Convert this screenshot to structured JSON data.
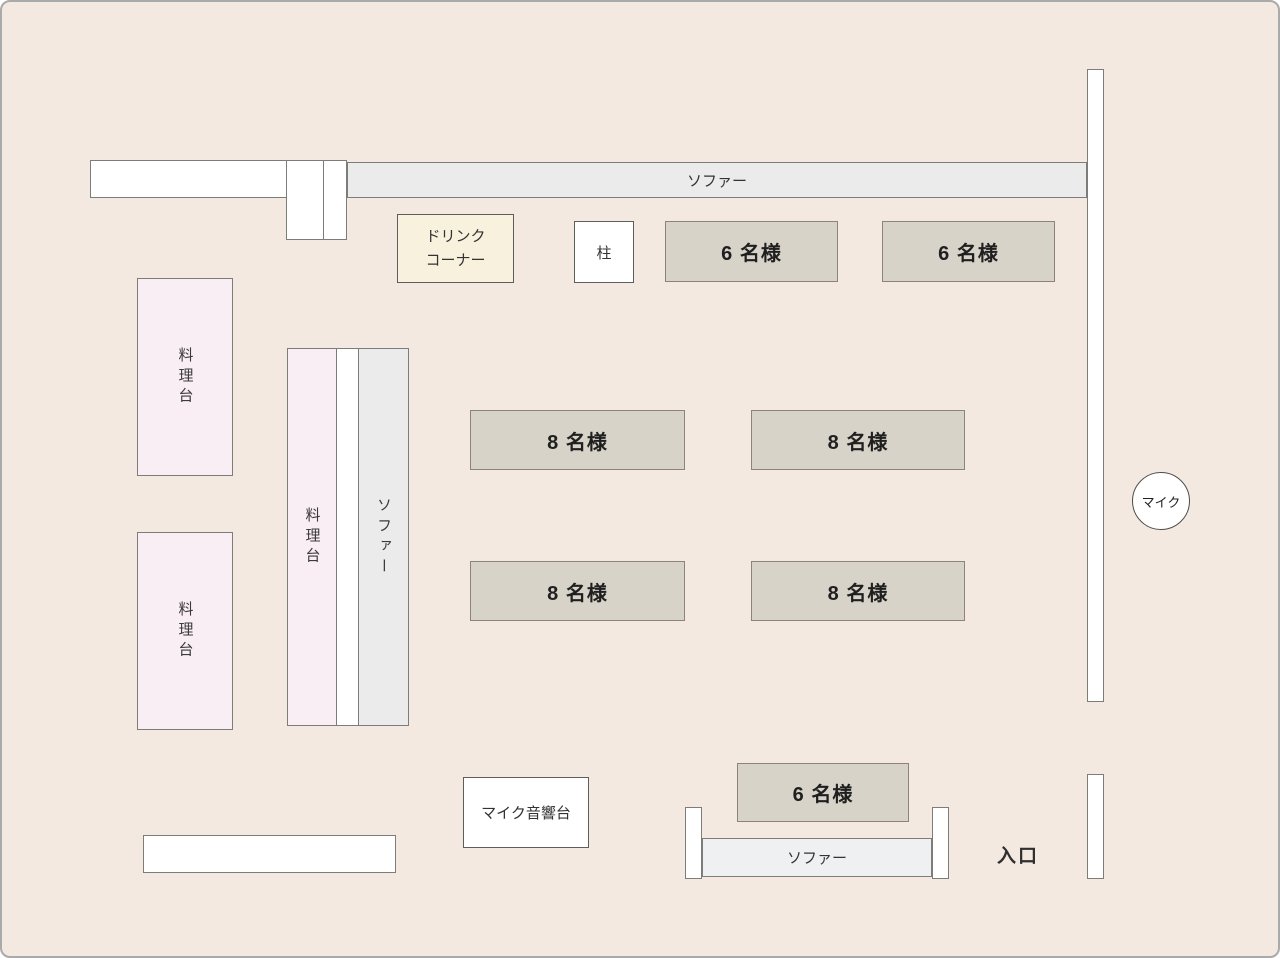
{
  "palette": {
    "background": "#f4e9e0",
    "wall_fill": "#ffffff",
    "sofa_fill": "#ebebeb",
    "sofa_bottom_fill": "#eef0f1",
    "seat_fill": "#d8d3c9",
    "cooking_fill": "#f9eef3",
    "drink_fill": "#f8f1dd",
    "outline": "#7c7c78",
    "seat_outline": "#8c8577",
    "frame": "#aaaaaa",
    "text": "#2b2b2b"
  },
  "floorplan": {
    "sofa_top": {
      "label": "ソファー"
    },
    "drink_corner": {
      "line1": "ドリンク",
      "line2": "コーナー"
    },
    "pillar": {
      "label": "柱"
    },
    "seats_6_top": [
      {
        "label": "6 名様"
      },
      {
        "label": "6 名様"
      }
    ],
    "seats_8": [
      {
        "label": "8 名様"
      },
      {
        "label": "8 名様"
      },
      {
        "label": "8 名様"
      },
      {
        "label": "8 名様"
      }
    ],
    "cooking_tables_left": [
      {
        "label": "料理台"
      },
      {
        "label": "料理台"
      }
    ],
    "island": {
      "cooking_label": "料理台",
      "sofa_label": "ソファー"
    },
    "mic": {
      "label": "マイク"
    },
    "mic_sound_table": {
      "label": "マイク音響台"
    },
    "stage_area": {
      "seat_label": "6 名様",
      "sofa_label": "ソファー"
    },
    "entrance": {
      "label": "入口"
    }
  }
}
